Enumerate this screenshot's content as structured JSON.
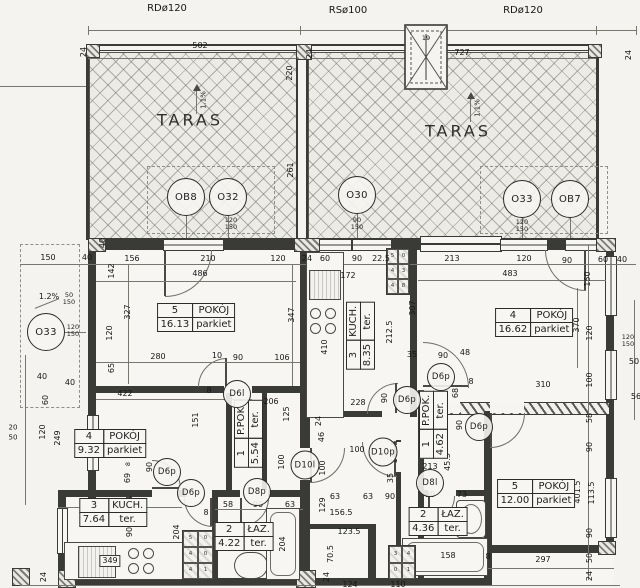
{
  "meta": {
    "drawing_type": "floor plan (rzut)",
    "language": "pl"
  },
  "top": {
    "roof_labels": [
      {
        "t": "RDø120",
        "x": 167,
        "y": 9
      },
      {
        "t": "RSø100",
        "x": 348,
        "y": 11
      },
      {
        "t": "RDø120",
        "x": 523,
        "y": 11
      }
    ],
    "taras_left": "TARAS",
    "taras_right": "TARAS",
    "slope_left": "1.1%",
    "slope_right": "1.1%",
    "slope_side": "1.2%",
    "skylight_label": "19"
  },
  "opening_circles": [
    {
      "label": "OB8",
      "x": 186,
      "y": 197,
      "d": 36
    },
    {
      "label": "O32",
      "x": 228,
      "y": 197,
      "d": 36
    },
    {
      "label": "O30",
      "x": 357,
      "y": 195,
      "d": 36
    },
    {
      "label": "O33",
      "x": 522,
      "y": 199,
      "d": 36
    },
    {
      "label": "OB7",
      "x": 570,
      "y": 199,
      "d": 36
    },
    {
      "label": "O33",
      "x": 46,
      "y": 332,
      "d": 36
    }
  ],
  "door_circles": [
    {
      "label": "D6l",
      "x": 237,
      "y": 394,
      "d": 26
    },
    {
      "label": "D6p",
      "x": 407,
      "y": 400,
      "d": 26
    },
    {
      "label": "D6p",
      "x": 441,
      "y": 377,
      "d": 26
    },
    {
      "label": "D6p",
      "x": 479,
      "y": 427,
      "d": 26
    },
    {
      "label": "D6p",
      "x": 167,
      "y": 472,
      "d": 26
    },
    {
      "label": "D6p",
      "x": 191,
      "y": 493,
      "d": 26
    },
    {
      "label": "D8p",
      "x": 257,
      "y": 492,
      "d": 26
    },
    {
      "label": "D10l",
      "x": 305,
      "y": 465,
      "d": 27
    },
    {
      "label": "D10p",
      "x": 383,
      "y": 452,
      "d": 27
    },
    {
      "label": "D8l",
      "x": 430,
      "y": 483,
      "d": 26
    }
  ],
  "rooms": [
    {
      "num": "5",
      "name": "POKÓJ",
      "area": "16.13",
      "floor": "parkiet",
      "x": 196,
      "y": 317,
      "v": 0
    },
    {
      "num": "4",
      "name": "POKÓJ",
      "area": "16.62",
      "floor": "parkiet",
      "x": 534,
      "y": 322,
      "v": 0
    },
    {
      "num": "4",
      "name": "POKÓJ",
      "area": "9.32",
      "floor": "parkiet",
      "x": 110,
      "y": 443,
      "v": 0
    },
    {
      "num": "5",
      "name": "POKÓJ",
      "area": "12.00",
      "floor": "parkiet",
      "x": 536,
      "y": 493,
      "v": 0
    },
    {
      "num": "3",
      "name": "KUCH.",
      "area": "8.35",
      "floor": "ter.",
      "x": 360,
      "y": 336,
      "v": 1
    },
    {
      "num": "3",
      "name": "KUCH.",
      "area": "7.64",
      "floor": "ter.",
      "x": 113,
      "y": 512,
      "v": 0
    },
    {
      "num": "2",
      "name": "ŁAZ.",
      "area": "4.22",
      "floor": "ter.",
      "x": 244,
      "y": 536,
      "v": 0
    },
    {
      "num": "2",
      "name": "ŁAZ.",
      "area": "4.36",
      "floor": "ter.",
      "x": 438,
      "y": 521,
      "v": 0
    },
    {
      "num": "1",
      "name": "P.POK.",
      "area": "5.54",
      "floor": "ter.",
      "x": 248,
      "y": 434,
      "v": 1
    },
    {
      "num": "1",
      "name": "P.POK.",
      "area": "4.62",
      "floor": "ter.",
      "x": 433,
      "y": 425,
      "v": 1
    }
  ],
  "window_notes": [
    {
      "lines": [
        "90",
        "150"
      ],
      "x": 357,
      "y": 224
    },
    {
      "lines": [
        "120",
        "150"
      ],
      "x": 231,
      "y": 224
    },
    {
      "lines": [
        "120",
        "150"
      ],
      "x": 522,
      "y": 226
    },
    {
      "lines": [
        "120",
        "150"
      ],
      "x": 73,
      "y": 331
    },
    {
      "lines": [
        "50",
        "150"
      ],
      "x": 69,
      "y": 299
    },
    {
      "lines": [
        "120",
        "150"
      ],
      "x": 628,
      "y": 341
    }
  ],
  "flues": [
    {
      "x": 386,
      "y": 248,
      "w": 22,
      "h": 45,
      "cols": 2,
      "cells": [
        "5",
        "0",
        "4",
        "3",
        "4",
        "8"
      ]
    },
    {
      "x": 182,
      "y": 530,
      "w": 30,
      "h": 48,
      "cols": 2,
      "cells": [
        "5",
        "0",
        "4",
        "0",
        "4",
        "1"
      ]
    },
    {
      "x": 388,
      "y": 545,
      "w": 26,
      "h": 33,
      "cols": 2,
      "cells": [
        "3",
        "4",
        "0",
        "1"
      ]
    }
  ],
  "dims": [
    {
      "t": "502",
      "x": 200,
      "y": 46
    },
    {
      "t": "727",
      "x": 462,
      "y": 53
    },
    {
      "t": "24",
      "x": 84,
      "y": 52,
      "r": 1
    },
    {
      "t": "24",
      "x": 310,
      "y": 54,
      "r": 1
    },
    {
      "t": "24",
      "x": 629,
      "y": 55,
      "r": 1
    },
    {
      "t": "220",
      "x": 290,
      "y": 73,
      "r": 1
    },
    {
      "t": "261",
      "x": 291,
      "y": 170,
      "r": 1
    },
    {
      "t": "150",
      "x": 48,
      "y": 258
    },
    {
      "t": "40",
      "x": 87,
      "y": 258
    },
    {
      "t": "156",
      "x": 132,
      "y": 259
    },
    {
      "t": "210",
      "x": 208,
      "y": 259
    },
    {
      "t": "120",
      "x": 278,
      "y": 259
    },
    {
      "t": "24",
      "x": 307,
      "y": 259
    },
    {
      "t": "60",
      "x": 325,
      "y": 259
    },
    {
      "t": "90",
      "x": 357,
      "y": 259
    },
    {
      "t": "22.5",
      "x": 381,
      "y": 259
    },
    {
      "t": "213",
      "x": 452,
      "y": 259
    },
    {
      "t": "120",
      "x": 524,
      "y": 259
    },
    {
      "t": "90",
      "x": 567,
      "y": 261
    },
    {
      "t": "60",
      "x": 603,
      "y": 260
    },
    {
      "t": "40",
      "x": 622,
      "y": 260
    },
    {
      "t": "486",
      "x": 200,
      "y": 274
    },
    {
      "t": "172",
      "x": 348,
      "y": 276
    },
    {
      "t": "483",
      "x": 510,
      "y": 274
    },
    {
      "t": "40",
      "x": 103,
      "y": 243,
      "r": 1
    },
    {
      "t": "142",
      "x": 112,
      "y": 271,
      "r": 1
    },
    {
      "t": "327",
      "x": 128,
      "y": 312,
      "r": 1
    },
    {
      "t": "120",
      "x": 110,
      "y": 333,
      "r": 1
    },
    {
      "t": "347",
      "x": 292,
      "y": 315,
      "r": 1
    },
    {
      "t": "307",
      "x": 413,
      "y": 308,
      "r": 1
    },
    {
      "t": "212.5",
      "x": 390,
      "y": 332,
      "r": 1
    },
    {
      "t": "410",
      "x": 325,
      "y": 347,
      "r": 1
    },
    {
      "t": "370",
      "x": 577,
      "y": 325,
      "r": 1
    },
    {
      "t": "150",
      "x": 588,
      "y": 279,
      "r": 1
    },
    {
      "t": "120",
      "x": 590,
      "y": 333,
      "r": 1
    },
    {
      "t": "100",
      "x": 590,
      "y": 380,
      "r": 1
    },
    {
      "t": "50",
      "x": 634,
      "y": 362
    },
    {
      "t": "56",
      "x": 636,
      "y": 397
    },
    {
      "t": "280",
      "x": 158,
      "y": 357
    },
    {
      "t": "10",
      "x": 217,
      "y": 356
    },
    {
      "t": "90",
      "x": 238,
      "y": 358
    },
    {
      "t": "106",
      "x": 282,
      "y": 358
    },
    {
      "t": "65",
      "x": 112,
      "y": 368,
      "r": 1
    },
    {
      "t": "422",
      "x": 125,
      "y": 394
    },
    {
      "t": "8",
      "x": 209,
      "y": 391
    },
    {
      "t": "151",
      "x": 196,
      "y": 420,
      "r": 1
    },
    {
      "t": "206",
      "x": 271,
      "y": 402
    },
    {
      "t": "125",
      "x": 287,
      "y": 414,
      "r": 1
    },
    {
      "t": "100",
      "x": 282,
      "y": 462,
      "r": 1
    },
    {
      "t": "20",
      "x": 13,
      "y": 428,
      "s": 7
    },
    {
      "t": "50",
      "x": 13,
      "y": 438,
      "s": 7
    },
    {
      "t": "120",
      "x": 43,
      "y": 432,
      "r": 1
    },
    {
      "t": "60",
      "x": 46,
      "y": 400,
      "r": 1
    },
    {
      "t": "249",
      "x": 58,
      "y": 438,
      "r": 1
    },
    {
      "t": "40",
      "x": 70,
      "y": 383
    },
    {
      "t": "40",
      "x": 42,
      "y": 377
    },
    {
      "t": "90",
      "x": 150,
      "y": 467,
      "r": 1
    },
    {
      "t": "8",
      "x": 128,
      "y": 464,
      "r": 1,
      "s": 6.5
    },
    {
      "t": "69",
      "x": 128,
      "y": 478,
      "r": 1
    },
    {
      "t": "54",
      "x": 130,
      "y": 501,
      "r": 1
    },
    {
      "t": "90",
      "x": 130,
      "y": 532,
      "r": 1
    },
    {
      "t": "204",
      "x": 177,
      "y": 532,
      "r": 1
    },
    {
      "t": "327",
      "x": 102,
      "y": 503
    },
    {
      "t": "228",
      "x": 358,
      "y": 403
    },
    {
      "t": "90",
      "x": 385,
      "y": 398,
      "r": 1
    },
    {
      "t": "35",
      "x": 412,
      "y": 355
    },
    {
      "t": "90",
      "x": 443,
      "y": 356
    },
    {
      "t": "68",
      "x": 456,
      "y": 393,
      "r": 1
    },
    {
      "t": "24",
      "x": 319,
      "y": 421,
      "r": 1
    },
    {
      "t": "46",
      "x": 322,
      "y": 437,
      "r": 1
    },
    {
      "t": "100",
      "x": 357,
      "y": 450
    },
    {
      "t": "100",
      "x": 323,
      "y": 468,
      "r": 1
    },
    {
      "t": "129",
      "x": 323,
      "y": 505,
      "r": 1
    },
    {
      "t": "141.5",
      "x": 395,
      "y": 452,
      "r": 1
    },
    {
      "t": "156.5",
      "x": 341,
      "y": 513
    },
    {
      "t": "35",
      "x": 391,
      "y": 478,
      "r": 1
    },
    {
      "t": "63",
      "x": 335,
      "y": 497
    },
    {
      "t": "63",
      "x": 368,
      "y": 497
    },
    {
      "t": "90",
      "x": 390,
      "y": 497
    },
    {
      "t": "90",
      "x": 430,
      "y": 495
    },
    {
      "t": "73",
      "x": 462,
      "y": 495
    },
    {
      "t": "45.5",
      "x": 448,
      "y": 462,
      "r": 1
    },
    {
      "t": "213",
      "x": 430,
      "y": 467
    },
    {
      "t": "48",
      "x": 465,
      "y": 353
    },
    {
      "t": "310",
      "x": 543,
      "y": 385
    },
    {
      "t": "8",
      "x": 471,
      "y": 382
    },
    {
      "t": "90",
      "x": 460,
      "y": 425,
      "r": 1
    },
    {
      "t": "58",
      "x": 590,
      "y": 418,
      "r": 1
    },
    {
      "t": "90",
      "x": 590,
      "y": 447,
      "r": 1
    },
    {
      "t": "401.5",
      "x": 578,
      "y": 492,
      "r": 1
    },
    {
      "t": "113.5",
      "x": 592,
      "y": 493,
      "r": 1
    },
    {
      "t": "90",
      "x": 590,
      "y": 533,
      "r": 1
    },
    {
      "t": "50",
      "x": 590,
      "y": 558,
      "r": 1
    },
    {
      "t": "24",
      "x": 590,
      "y": 576,
      "r": 1
    },
    {
      "t": "297",
      "x": 543,
      "y": 560
    },
    {
      "t": "8",
      "x": 488,
      "y": 557
    },
    {
      "t": "158",
      "x": 448,
      "y": 556
    },
    {
      "t": "211",
      "x": 252,
      "y": 548
    },
    {
      "t": "204",
      "x": 283,
      "y": 544,
      "r": 1
    },
    {
      "t": "58",
      "x": 228,
      "y": 505
    },
    {
      "t": "90",
      "x": 258,
      "y": 505
    },
    {
      "t": "63",
      "x": 290,
      "y": 505
    },
    {
      "t": "8",
      "x": 206,
      "y": 513
    },
    {
      "t": "349",
      "x": 110,
      "y": 561,
      "b": 1
    },
    {
      "t": "24",
      "x": 44,
      "y": 577,
      "r": 1
    },
    {
      "t": "70.5",
      "x": 331,
      "y": 554,
      "r": 1
    },
    {
      "t": "24",
      "x": 327,
      "y": 577,
      "r": 1
    },
    {
      "t": "123.5",
      "x": 349,
      "y": 532
    },
    {
      "t": "124",
      "x": 350,
      "y": 585
    },
    {
      "t": "110",
      "x": 398,
      "y": 585
    },
    {
      "t": "1.2%",
      "x": 49,
      "y": 297
    },
    {
      "t": "19",
      "x": 426,
      "y": 38,
      "s": 6.5
    }
  ]
}
